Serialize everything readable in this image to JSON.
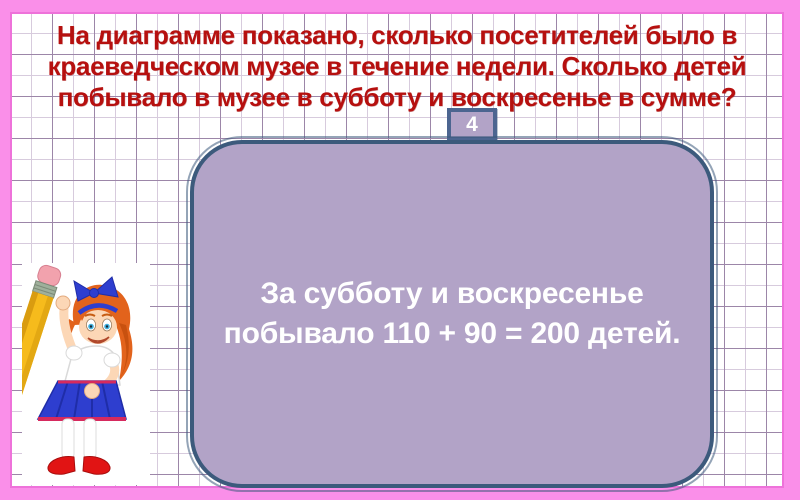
{
  "slide": {
    "number": "4",
    "question": {
      "lines": [
        "На диаграмме показано, сколько посетителей было в",
        "краеведческом музее в течение недели. Сколько детей",
        "побывало в музее в субботу и воскресенье в сумме?"
      ]
    },
    "answer": {
      "lines": [
        "За субботу и воскресенье",
        "побывало 110 + 90 = 200 детей."
      ]
    },
    "illustration": "girl-with-giant-pencil"
  },
  "colors": {
    "frame-pink": "#fa8fe9",
    "frame-pink-dark": "#ee72da",
    "title-red": "#b6100f",
    "panel-fill": "#b2a3c7",
    "panel-border": "#3c5a7c",
    "badge-border": "#4c6590",
    "grid-strong": "#9c86a8",
    "grid-weak": "#d7cbdd",
    "answer-white": "#ffffff"
  }
}
